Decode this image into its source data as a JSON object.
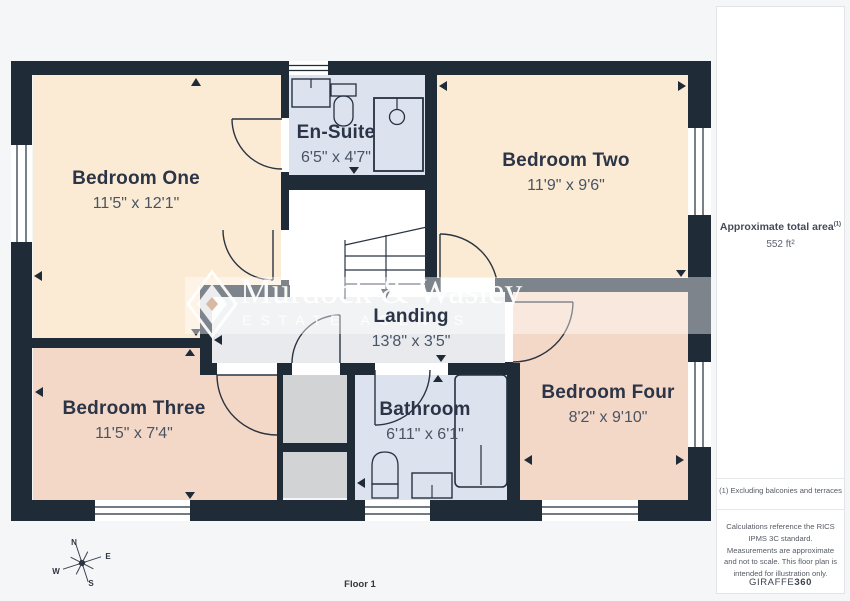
{
  "floorplan": {
    "floor_label": "Floor 1",
    "rooms": [
      {
        "name": "Bedroom One",
        "dims": "11'5\" x 12'1\""
      },
      {
        "name": "En-Suite",
        "dims": "6'5\" x 4'7\""
      },
      {
        "name": "Bedroom Two",
        "dims": "11'9\" x 9'6\""
      },
      {
        "name": "Landing",
        "dims": "13'8\" x 3'5\""
      },
      {
        "name": "Bedroom Three",
        "dims": "11'5\" x 7'4\""
      },
      {
        "name": "Bathroom",
        "dims": "6'11\" x 6'1\""
      },
      {
        "name": "Bedroom Four",
        "dims": "8'2\" x 9'10\""
      }
    ],
    "compass": {
      "n": "N",
      "e": "E",
      "s": "S",
      "w": "W"
    }
  },
  "watermark": {
    "title": "Murdock & Wasley",
    "subtitle": "ESTATE AGENTS"
  },
  "sidebar": {
    "area_title": "Approximate total area",
    "area_superscript": "(1)",
    "area_value": "552 ft²",
    "footnote": "(1) Excluding balconies and terraces",
    "disclaimer": "Calculations reference the RICS IPMS 3C standard. Measurements are approximate and not to scale. This floor plan is intended for illustration only.",
    "brand": "GIRAFFE",
    "brand_suffix": "360"
  },
  "colors": {
    "wall": "#202b38",
    "bedroom_cream": "#fbebd5",
    "bedroom_pink": "#f4d8c7",
    "wet_room_blue": "#dde3ee",
    "landing_gray": "#e8eaee",
    "cupboard_gray": "#d2d3d5"
  }
}
